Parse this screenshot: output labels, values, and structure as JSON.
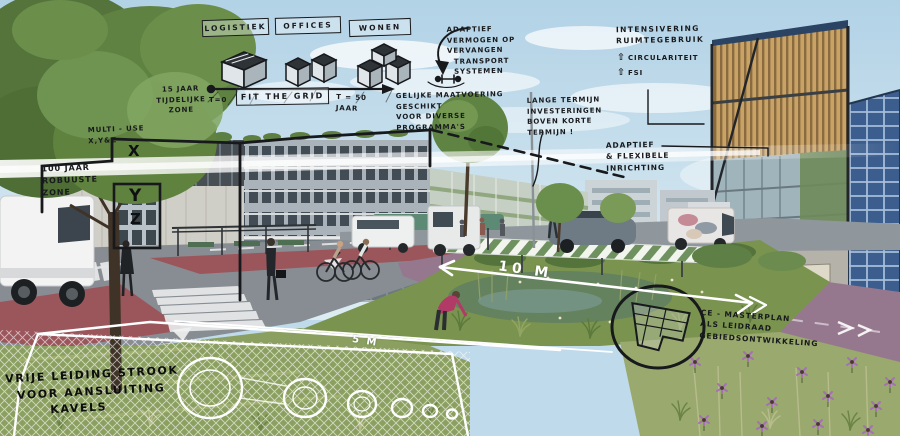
{
  "legend": {
    "logistiek": "LOGISTIEK",
    "offices": "OFFICES",
    "wonen": "WONEN"
  },
  "timeline": {
    "t_start": "T=0",
    "fit_the_grid": "FIT THE GRID",
    "t_end": "T = 50 JAAR"
  },
  "notes": {
    "tijdelijke_zone": "15 JAAR\nTIJDELIJKE\nZONE",
    "adaptief_vermogen": "ADAPTIEF\nVERMOGEN OP\nVERVANGEN\n  TRANSPORT\n  SYSTEMEN",
    "intensivering": "INTENSIVERING\nRUIMTEGEBRUIK",
    "up_arrow": "⇧",
    "circulariteit": "CIRCULARITEIT",
    "fsi": "FSI",
    "gelijke_maatvoering": "GELIJKE MAATVOERING\nGESCHIKT\nVOOR DIVERSE\nPROGRAMMA'S",
    "lange_termijn": "LANGE TERMIJN\nINVESTERINGEN\nBOVEN KORTE\nTERMIJN !",
    "multi_use": "MULTI - USE\nX,Y&Z",
    "robuuste_zone": "100 JAAR\nROBUUSTE\nZONE",
    "adaptief_flexibel": "ADAPTIEF\n& FLEXIBELE\nINRICHTING",
    "ce_masterplan": "CE - MASTERPLAN\nALS LEIDRAAD\nGEBIEDSONTWIKKELING",
    "vrije_leiding": "VRIJE LEIDING STROOK\n  VOOR AANSLUITING\n        KAVELS"
  },
  "dimensions": {
    "green_zone_width": "10 M",
    "pipe_strip_width": "5 M"
  },
  "building_marks": {
    "x": "X",
    "y": "Y",
    "z": "Z"
  },
  "colors": {
    "sky": "#bfdaea",
    "annotation_ink": "#17191c",
    "sketch_white": "#ffffff",
    "bike_lane": "#9c5157",
    "path_purple": "#96788e",
    "green": "#7a9450",
    "solar_blue": "#3c5e8e",
    "louver_wood": "#c9a265"
  }
}
